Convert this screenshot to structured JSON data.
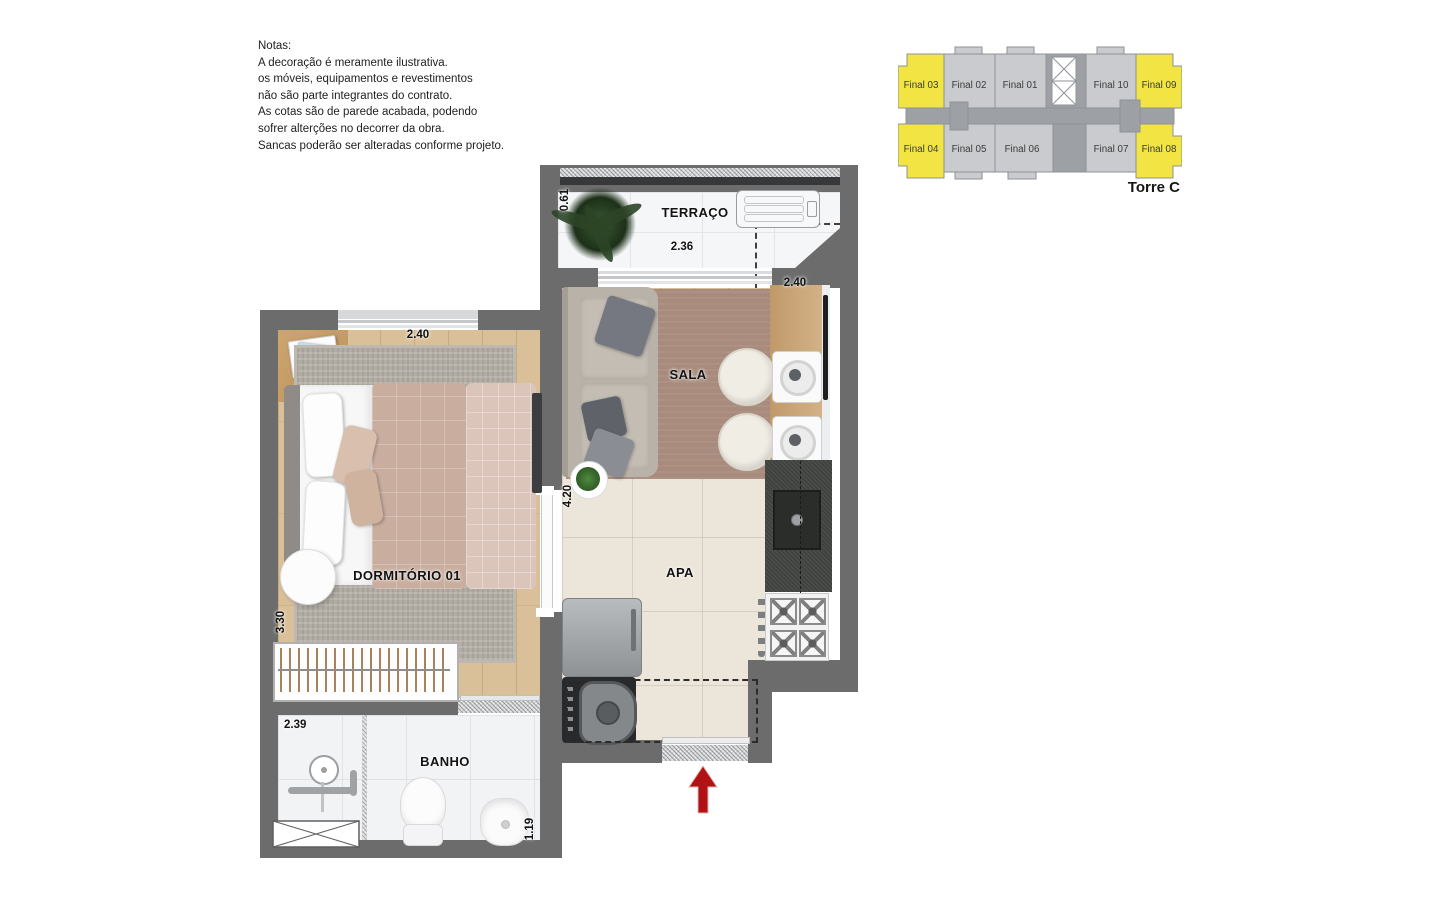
{
  "notes": {
    "title": "Notas:",
    "lines": [
      "A decoração é meramente ilustrativa.",
      "os móveis, equipamentos e revestimentos",
      "não são parte integrantes do contrato.",
      "As cotas são de parede acabada, podendo",
      "sofrer alterções no decorrer da obra.",
      "Sancas poderão ser alteradas conforme projeto."
    ]
  },
  "key_plan": {
    "tower_label": "Torre C",
    "colors": {
      "highlight": "#f2e442",
      "unit": "#c9cbce",
      "core": "#9da0a4",
      "outline": "#8f9296"
    },
    "top_row": [
      {
        "label": "Final 03",
        "highlighted": true
      },
      {
        "label": "Final 02",
        "highlighted": false
      },
      {
        "label": "Final 01",
        "highlighted": false
      },
      {
        "label": "Final 10",
        "highlighted": false
      },
      {
        "label": "Final 09",
        "highlighted": true
      }
    ],
    "bottom_row": [
      {
        "label": "Final 04",
        "highlighted": true
      },
      {
        "label": "Final 05",
        "highlighted": false
      },
      {
        "label": "Final 06",
        "highlighted": false
      },
      {
        "label": "Final 07",
        "highlighted": false
      },
      {
        "label": "Final 08",
        "highlighted": true
      }
    ]
  },
  "floor_plan": {
    "wall_color": "#6c6c6c",
    "entry_arrow_color": "#b11315",
    "rooms": {
      "terraco": {
        "name": "TERRAÇO",
        "width": "2.36",
        "depth": "0.61"
      },
      "sala": {
        "name": "SALA",
        "counter_width": "2.40"
      },
      "apa": {
        "name": "APA",
        "length": "4.20"
      },
      "dormitorio": {
        "name": "DORMITÓRIO 01",
        "width": "2.40",
        "depth": "3.30"
      },
      "banho": {
        "name": "BANHO",
        "width": "2.39",
        "depth": "1.19"
      }
    }
  }
}
